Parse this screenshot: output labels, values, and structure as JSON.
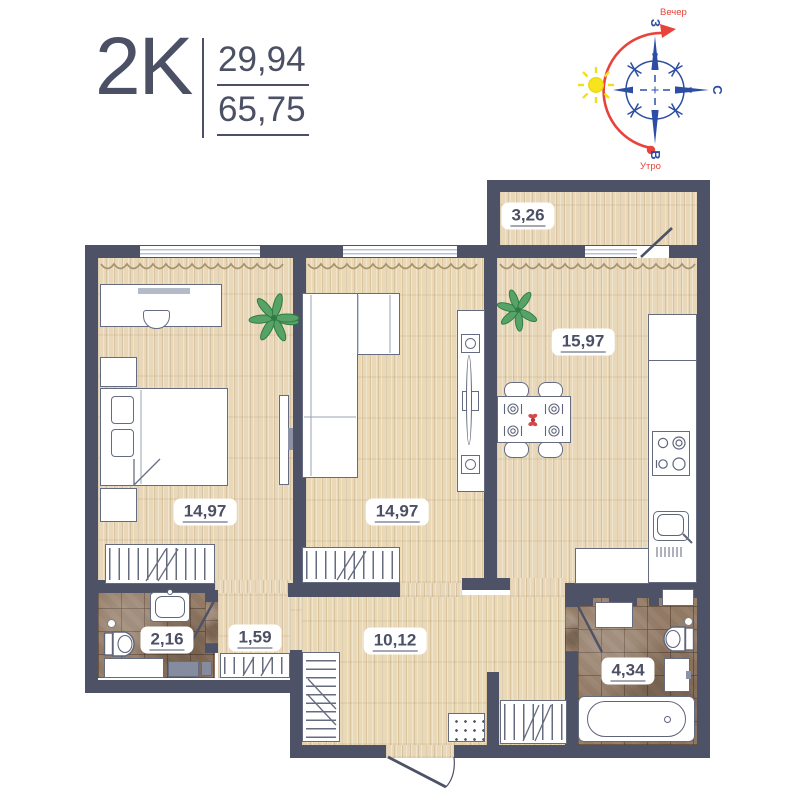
{
  "header": {
    "type": "2K",
    "area_living": "29,94",
    "area_total": "65,75"
  },
  "compass": {
    "evening": "Вечер",
    "morning": "Утро",
    "dir_top": "З",
    "dir_right": "С",
    "dir_bottom": "В"
  },
  "rooms": {
    "balcony": {
      "area": "3,26"
    },
    "kitchen": {
      "area": "15,97"
    },
    "bedroom": {
      "area": "14,97"
    },
    "living_room": {
      "area": "14,97"
    },
    "bathroom": {
      "area": "2,16"
    },
    "hallway": {
      "area": "1,59"
    },
    "corridor": {
      "area": "10,12"
    },
    "bathroom_2": {
      "area": "4,34"
    }
  },
  "colors": {
    "wall": "#4d5266",
    "wood": "#e8d8b9",
    "tile": "#917964",
    "compass_blue": "#2b4da3",
    "compass_red": "#e8433a",
    "sun_yellow": "#f6e41f",
    "text": "#4b5064"
  }
}
